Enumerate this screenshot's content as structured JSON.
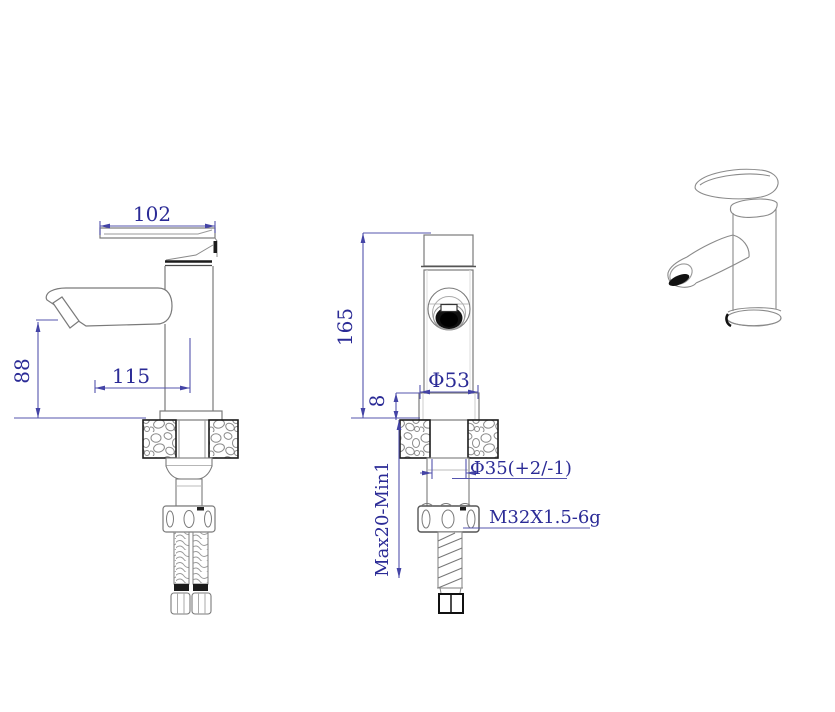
{
  "drawing": {
    "type": "technical-drawing",
    "subject": "single-lever basin mixer faucet",
    "views": [
      {
        "id": "side",
        "name": "side view with supply hoses"
      },
      {
        "id": "front",
        "name": "front view with installation section"
      },
      {
        "id": "isometric",
        "name": "isometric view"
      }
    ],
    "dimensions": {
      "handle_length": "102",
      "spout_reach": "115",
      "spout_height": "88",
      "total_height": "165",
      "base_plate_height": "8",
      "base_diameter": "Φ53",
      "hole_diameter": "Φ35(+2/-1)",
      "clamp_range": "Max20-Min1",
      "thread_spec": "M32X1.5-6g"
    },
    "colors": {
      "dimension_line": "#5454ae",
      "dimension_text": "#2b2b96",
      "part_line": "#7a7a7a",
      "accent_dark": "#1c1c1c",
      "background": "#ffffff"
    }
  }
}
